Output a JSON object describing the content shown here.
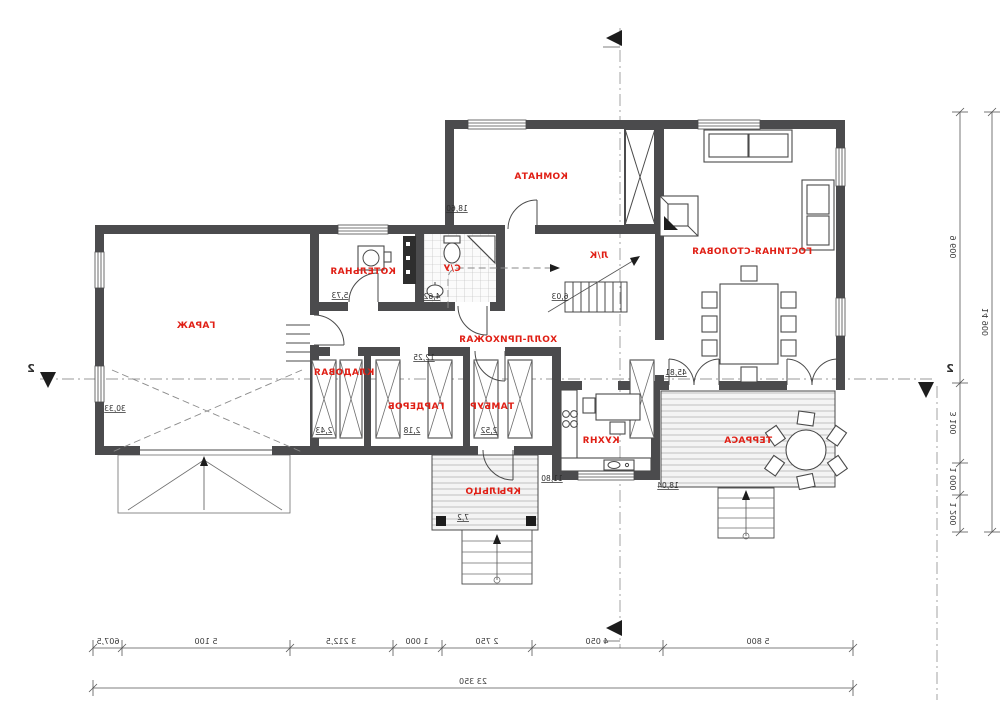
{
  "plan": {
    "rooms": [
      {
        "name": "ГАРАЖ",
        "area": "30,33"
      },
      {
        "name": "КОТЕЛЬНАЯ",
        "area": "5,73"
      },
      {
        "name": "С/У",
        "area": "4,62"
      },
      {
        "name": "КОМНАТА",
        "area": "18,60"
      },
      {
        "name": "ГОСТИНАЯ-СТОЛОВАЯ",
        "area": "45,81"
      },
      {
        "name": "ХОЛЛ-ПРИХОЖАЯ",
        "area": "12,25"
      },
      {
        "name": "Л/К",
        "area": "6,03"
      },
      {
        "name": "КЛАДОВАЯ",
        "area": "2,43"
      },
      {
        "name": "ГАРДЕРОБ",
        "area": "2,18"
      },
      {
        "name": "ТАМБУР",
        "area": "2,52"
      },
      {
        "name": "КУХНЯ",
        "area": "11,80"
      },
      {
        "name": "ТЕРРАСА",
        "area": "18,04"
      },
      {
        "name": "КРЫЛЬЦО",
        "area": "7,2"
      }
    ],
    "dims_bottom": {
      "segments": [
        "607,5",
        "5 100",
        "3 212,5",
        "1 000",
        "2 750",
        "4 050",
        "5 800"
      ],
      "total": "23 350"
    },
    "dims_right": {
      "segments": [
        "9 600",
        "3 100",
        "1 000",
        "1 200"
      ],
      "total": "14 900"
    },
    "section": {
      "label_left": "2",
      "label_right": "2"
    },
    "colors": {
      "wall": "#4b4b4d",
      "room_label": "#e01f15",
      "line": "#4a4a4a"
    }
  }
}
